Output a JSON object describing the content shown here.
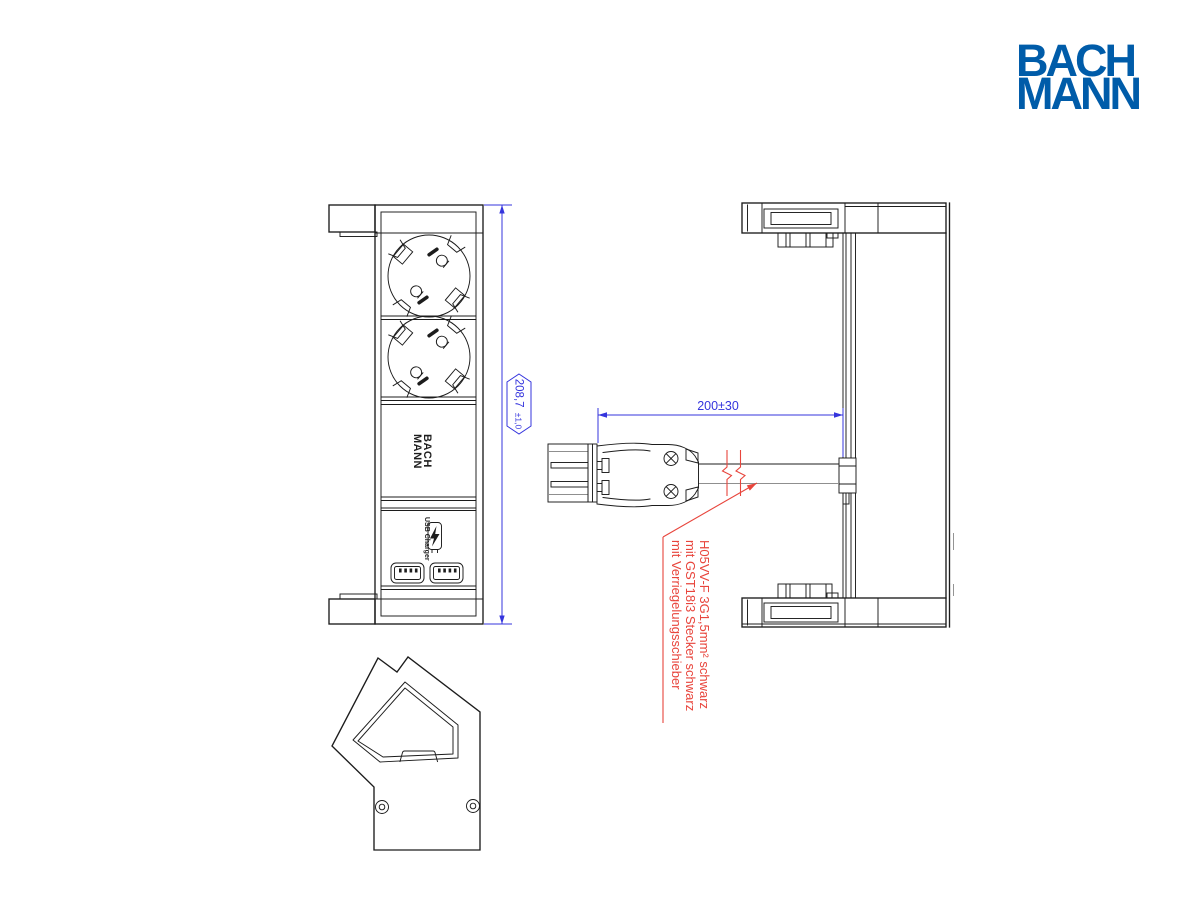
{
  "brand_logo": {
    "line1": "BACH",
    "line2": "MANN",
    "color": "#005CA9"
  },
  "front_view": {
    "device_logo_line1": "BACH",
    "device_logo_line2": "MANN",
    "usb_label": "USB Charger"
  },
  "dimensions": {
    "overall_height": {
      "value": "208,7",
      "tolerance": "±1,0"
    },
    "cable_length": {
      "value": "200±30"
    }
  },
  "cable_note": {
    "lines": [
      "H05VV-F 3G1,5mm² schwarz",
      "mit GST18i3 Stecker schwarz",
      "mit Verriegelungsschieber"
    ]
  },
  "colors": {
    "brand_blue": "#005CA9",
    "dimension_blue": "#3434dd",
    "annotation_red": "#e8453c",
    "line_black": "#1c1c1c",
    "line_gray": "#8f8f8f"
  }
}
